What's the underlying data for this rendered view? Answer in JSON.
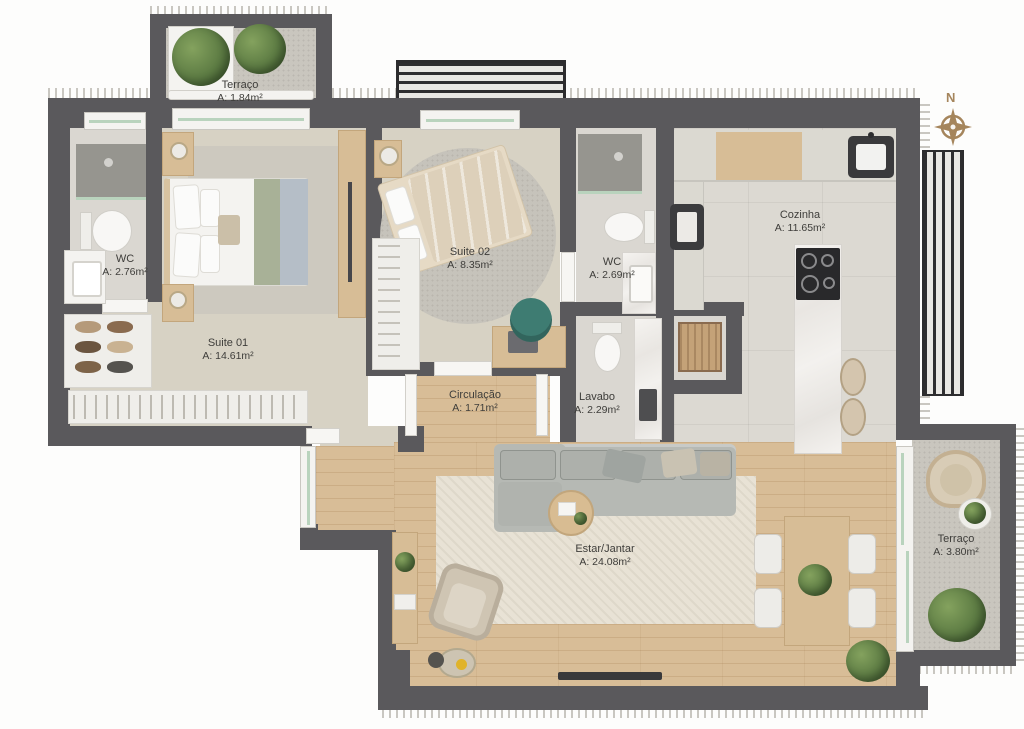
{
  "plan": {
    "compass_label": "N",
    "rooms": [
      {
        "name": "Terraço",
        "area": "A: 1.84m²"
      },
      {
        "name": "WC",
        "area": "A: 2.76m²"
      },
      {
        "name": "Suite 01",
        "area": "A: 14.61m²"
      },
      {
        "name": "Suite 02",
        "area": "A: 8.35m²"
      },
      {
        "name": "WC",
        "area": "A: 2.69m²"
      },
      {
        "name": "Cozinha",
        "area": "A: 11.65m²"
      },
      {
        "name": "Circulação",
        "area": "A: 1.71m²"
      },
      {
        "name": "Lavabo",
        "area": "A: 2.29m²"
      },
      {
        "name": "Estar/Jantar",
        "area": "A: 24.08m²"
      },
      {
        "name": "Terraço",
        "area": "A: 3.80m²"
      }
    ],
    "palette": {
      "wall": "#5a595c",
      "wood_floor": "#d8bd97",
      "bedroom_floor": "#d7d2c4",
      "kitchen_floor": "#dcd9d2",
      "terrace_floor": "#c9c6be",
      "rug": "#e8e2d5",
      "sofa": "#b6b9b4",
      "marble": "#f2f0ed",
      "glass": "#b9d3bd",
      "label_text": "#3e3d3a",
      "compass": "#a5855c"
    }
  }
}
